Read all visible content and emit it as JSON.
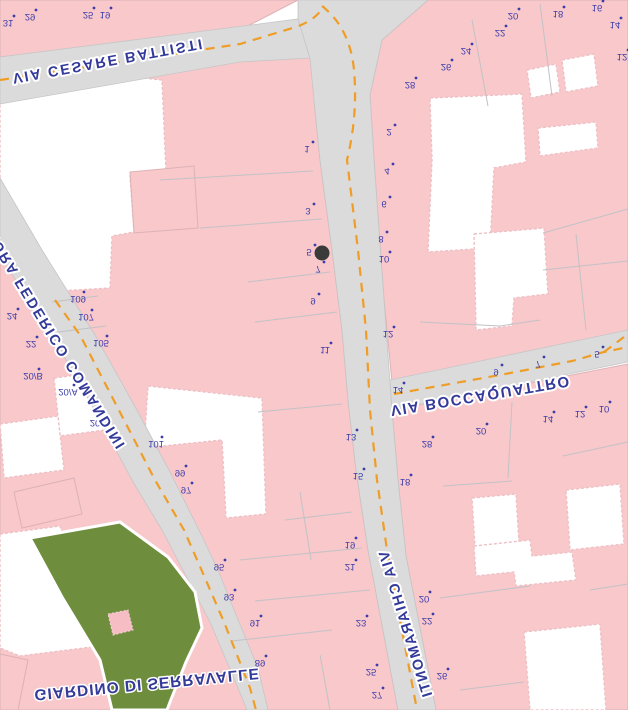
{
  "map": {
    "title": "city-map-flipped",
    "colors": {
      "building_pink": "#f8c8cb",
      "building_outline": "#dcb2b6",
      "road_gray": "#dbdbdb",
      "road_edge": "#c6c6c6",
      "parcel_line": "#c2c2c6",
      "centerline_orange": "#ef9d27",
      "label_navy": "#333a99",
      "number_blue": "#3d3daa",
      "garden_green": "#6e8e3e",
      "garden_square_pink": "#f6bdc4",
      "marker_black": "#3a3a3a",
      "courtyard_white": "#ffffff"
    },
    "streets": [
      {
        "name": "VIA CESARE BATTISTI",
        "x": 12,
        "y": 74,
        "angle": -10.5,
        "size": 14.5,
        "spacing": 2.0
      },
      {
        "name": "VIA MURA FEDERICO COMANDINI",
        "x": -26,
        "y": 198,
        "angle": 58.5,
        "size": 14.5,
        "spacing": 2.0
      },
      {
        "name": "VIA BOCCAQUATTRO",
        "x": 390,
        "y": 406,
        "angle": -9.5,
        "size": 15.0,
        "spacing": 1.6
      },
      {
        "name": "VIA CHIARAMONTI",
        "x": 388,
        "y": 550,
        "angle": 73.0,
        "size": 14.5,
        "spacing": 1.5
      }
    ],
    "places": [
      {
        "name": "GIARDINO DI SERRAVALLE",
        "x": 34,
        "y": 690,
        "angle": -5.5,
        "size": 15.5,
        "spacing": 1.0
      }
    ],
    "house_numbers": [
      {
        "n": "31",
        "x": 8,
        "y": 20
      },
      {
        "n": "29",
        "x": 30,
        "y": 14
      },
      {
        "n": "25",
        "x": 88,
        "y": 12
      },
      {
        "n": "19",
        "x": 105,
        "y": 12
      },
      {
        "n": "28",
        "x": 410,
        "y": 82
      },
      {
        "n": "26",
        "x": 446,
        "y": 64
      },
      {
        "n": "24",
        "x": 466,
        "y": 48
      },
      {
        "n": "22",
        "x": 500,
        "y": 30
      },
      {
        "n": "20",
        "x": 513,
        "y": 13
      },
      {
        "n": "18",
        "x": 558,
        "y": 11
      },
      {
        "n": "16",
        "x": 597,
        "y": 5
      },
      {
        "n": "14",
        "x": 615,
        "y": 22
      },
      {
        "n": "12",
        "x": 622,
        "y": 54
      },
      {
        "n": "1",
        "x": 307,
        "y": 146
      },
      {
        "n": "3",
        "x": 308,
        "y": 208
      },
      {
        "n": "5",
        "x": 309,
        "y": 249
      },
      {
        "n": "7",
        "x": 318,
        "y": 266
      },
      {
        "n": "9",
        "x": 313,
        "y": 298
      },
      {
        "n": "11",
        "x": 325,
        "y": 347
      },
      {
        "n": "13",
        "x": 351,
        "y": 434
      },
      {
        "n": "15",
        "x": 358,
        "y": 473
      },
      {
        "n": "19",
        "x": 350,
        "y": 542
      },
      {
        "n": "21",
        "x": 350,
        "y": 564
      },
      {
        "n": "23",
        "x": 361,
        "y": 620
      },
      {
        "n": "25",
        "x": 371,
        "y": 669
      },
      {
        "n": "27",
        "x": 377,
        "y": 692
      },
      {
        "n": "2",
        "x": 389,
        "y": 129
      },
      {
        "n": "4",
        "x": 387,
        "y": 168
      },
      {
        "n": "6",
        "x": 384,
        "y": 201
      },
      {
        "n": "8",
        "x": 381,
        "y": 236
      },
      {
        "n": "10",
        "x": 384,
        "y": 256
      },
      {
        "n": "12",
        "x": 388,
        "y": 331
      },
      {
        "n": "14",
        "x": 398,
        "y": 387
      },
      {
        "n": "28",
        "x": 427,
        "y": 441
      },
      {
        "n": "18",
        "x": 405,
        "y": 479
      },
      {
        "n": "20",
        "x": 424,
        "y": 596
      },
      {
        "n": "22",
        "x": 427,
        "y": 618
      },
      {
        "n": "26",
        "x": 442,
        "y": 673
      },
      {
        "n": "9",
        "x": 496,
        "y": 369
      },
      {
        "n": "7",
        "x": 538,
        "y": 361
      },
      {
        "n": "5",
        "x": 597,
        "y": 351
      },
      {
        "n": "20",
        "x": 481,
        "y": 428
      },
      {
        "n": "14",
        "x": 548,
        "y": 416
      },
      {
        "n": "12",
        "x": 580,
        "y": 411
      },
      {
        "n": "10",
        "x": 604,
        "y": 406
      },
      {
        "n": "109",
        "x": 78,
        "y": 296
      },
      {
        "n": "107",
        "x": 86,
        "y": 314
      },
      {
        "n": "105",
        "x": 101,
        "y": 340
      },
      {
        "n": "101",
        "x": 156,
        "y": 441
      },
      {
        "n": "99",
        "x": 180,
        "y": 470
      },
      {
        "n": "97",
        "x": 186,
        "y": 487
      },
      {
        "n": "95",
        "x": 219,
        "y": 564
      },
      {
        "n": "93",
        "x": 229,
        "y": 594
      },
      {
        "n": "91",
        "x": 255,
        "y": 620
      },
      {
        "n": "89",
        "x": 260,
        "y": 660
      },
      {
        "n": "24",
        "x": 12,
        "y": 313
      },
      {
        "n": "22",
        "x": 31,
        "y": 341
      },
      {
        "n": "20/B",
        "x": 33,
        "y": 373
      },
      {
        "n": "20/A",
        "x": 68,
        "y": 389
      },
      {
        "n": "20",
        "x": 95,
        "y": 420
      }
    ],
    "marker": {
      "x": 322,
      "y": 253,
      "r": 7.5
    }
  }
}
